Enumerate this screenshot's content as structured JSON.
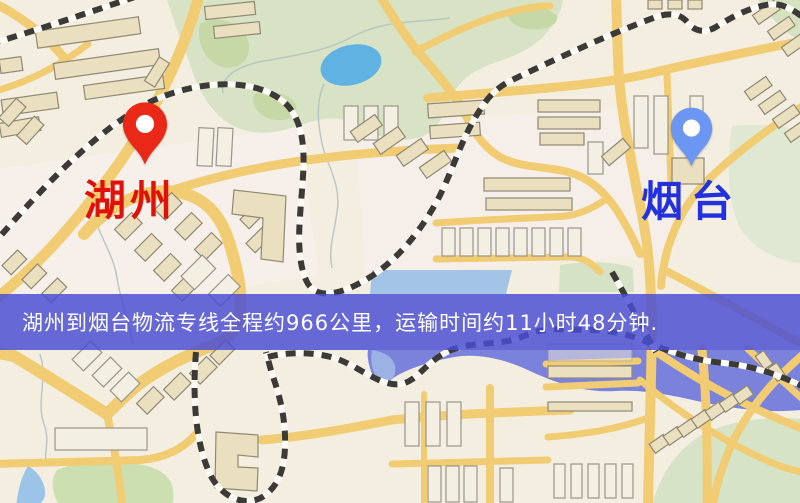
{
  "route": {
    "origin": {
      "label": "湖州"
    },
    "destination": {
      "label": "烟台"
    },
    "banner": {
      "text": "湖州到烟台物流专线全程约966公里，运输时间约11小时48分钟."
    }
  },
  "icons": {
    "origin_pin": "red-map-pin-icon",
    "destination_pin": "blue-map-pin-icon"
  },
  "colors": {
    "origin_pin": "#ea2817",
    "origin_label": "#e01108",
    "destination_pin": "#6b96f2",
    "destination_label": "#2231dd",
    "banner_bg": "#4a4dd3",
    "banner_text": "#ffffff",
    "road": "#f1cc72",
    "park": "#d7e3c4",
    "water": "#7a82dc",
    "lake": "#5fb2e2"
  }
}
